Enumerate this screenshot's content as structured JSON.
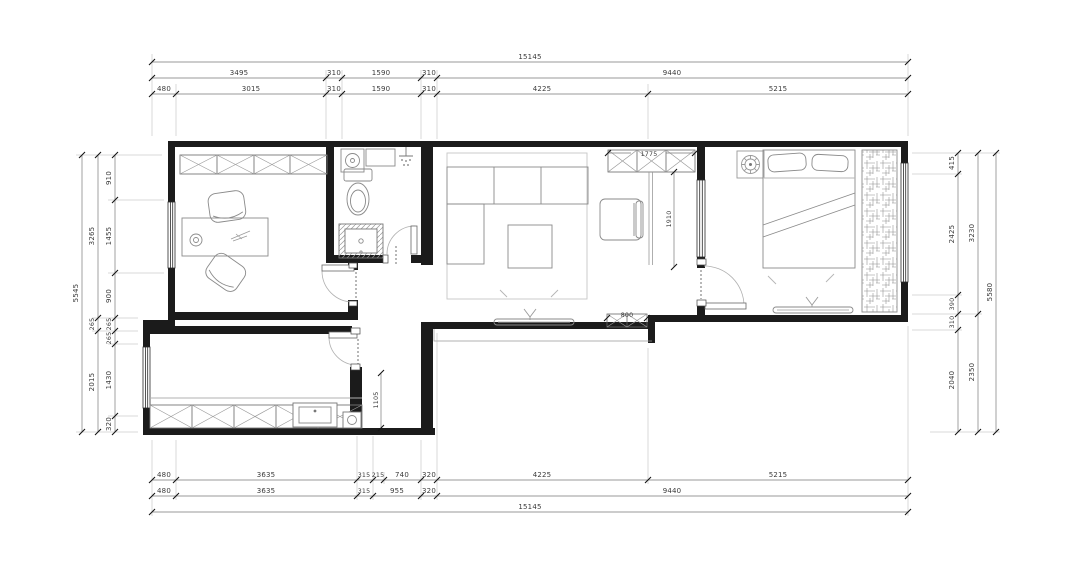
{
  "drawing": {
    "type": "floor-plan",
    "units": "mm"
  },
  "colors": {
    "wall": "#1b1b1b",
    "line": "#555555",
    "furniture": "#8a8a8a",
    "dim_text": "#3a3a3a",
    "hatch": "#999999",
    "background": "#ffffff"
  },
  "dims": {
    "top": {
      "row1": [
        "15145"
      ],
      "row2": [
        "3495",
        "310",
        "1590",
        "310",
        "9440"
      ],
      "row3": [
        "480",
        "3015",
        "310",
        "1590",
        "310",
        "4225",
        "5215"
      ]
    },
    "bottom": {
      "row1": [
        "480",
        "3635",
        "315",
        "215",
        "740",
        "320",
        "4225",
        "5215"
      ],
      "row2": [
        "480",
        "3635",
        "315",
        "955",
        "320",
        "9440"
      ],
      "row3": [
        "15145"
      ]
    },
    "left": {
      "inner": [
        "910",
        "1455",
        "900",
        "265",
        "265",
        "1430",
        "320"
      ],
      "middle": [
        "3265",
        "265",
        "2015"
      ],
      "outer": [
        "5545"
      ]
    },
    "right": {
      "inner": [
        "415",
        "2425",
        "390",
        "310",
        "2040"
      ],
      "middle": [
        "3230",
        "2350"
      ],
      "outer": [
        "5580"
      ]
    },
    "interior": {
      "entry_closet": "1775",
      "hall": "1910",
      "shoe_cabinet": "800",
      "kitchen_nook": "1105"
    }
  }
}
